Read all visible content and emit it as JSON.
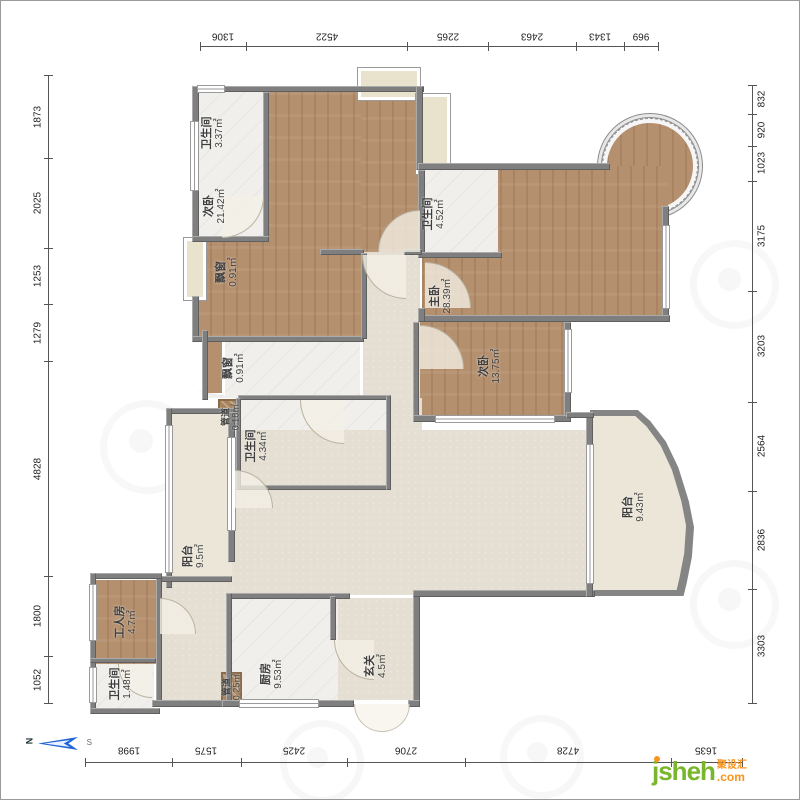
{
  "dimensions": {
    "top": [
      "1306",
      "4522",
      "2265",
      "2463",
      "1343",
      "969"
    ],
    "left": [
      "1873",
      "2025",
      "1253",
      "1279",
      "4828",
      "1800",
      "1052"
    ],
    "right": [
      "832",
      "920",
      "1023",
      "3175",
      "3203",
      "2564",
      "2836",
      "3303"
    ],
    "bottom": [
      "1998",
      "1575",
      "2425",
      "2706",
      "4728",
      "1635"
    ]
  },
  "rooms": [
    {
      "id": "bath1",
      "name": "卫生间",
      "area": "3.37㎡"
    },
    {
      "id": "bed2",
      "name": "次卧",
      "area": "21.42㎡"
    },
    {
      "id": "bay1",
      "name": "飘窗",
      "area": "0.91㎡"
    },
    {
      "id": "bath2",
      "name": "卫生间",
      "area": "4.52㎡"
    },
    {
      "id": "master",
      "name": "主卧",
      "area": "28.39㎡"
    },
    {
      "id": "bed3",
      "name": "次卧",
      "area": "13.75㎡"
    },
    {
      "id": "bay2",
      "name": "飘窗",
      "area": "0.91㎡"
    },
    {
      "id": "duct1",
      "name": "管道",
      "area": "0.18㎡"
    },
    {
      "id": "bath3",
      "name": "卫生间",
      "area": "4.34㎡"
    },
    {
      "id": "balcony1",
      "name": "阳台",
      "area": "9.5㎡"
    },
    {
      "id": "worker",
      "name": "工人房",
      "area": "4.7㎡"
    },
    {
      "id": "bath4",
      "name": "卫生间",
      "area": "1.48㎡"
    },
    {
      "id": "duct2",
      "name": "管道",
      "area": "0.25㎡"
    },
    {
      "id": "kitchen",
      "name": "厨房",
      "area": "9.53㎡"
    },
    {
      "id": "entry",
      "name": "玄关",
      "area": "4.5㎡"
    },
    {
      "id": "balcony2",
      "name": "阳台",
      "area": "9.43㎡"
    }
  ],
  "compass": {
    "north": "N",
    "south": "S"
  },
  "logo": {
    "text": "jsheh",
    "tld": ".com",
    "cn": "聚设汇",
    "green": "#7ab62c",
    "orange": "#f7941d"
  }
}
